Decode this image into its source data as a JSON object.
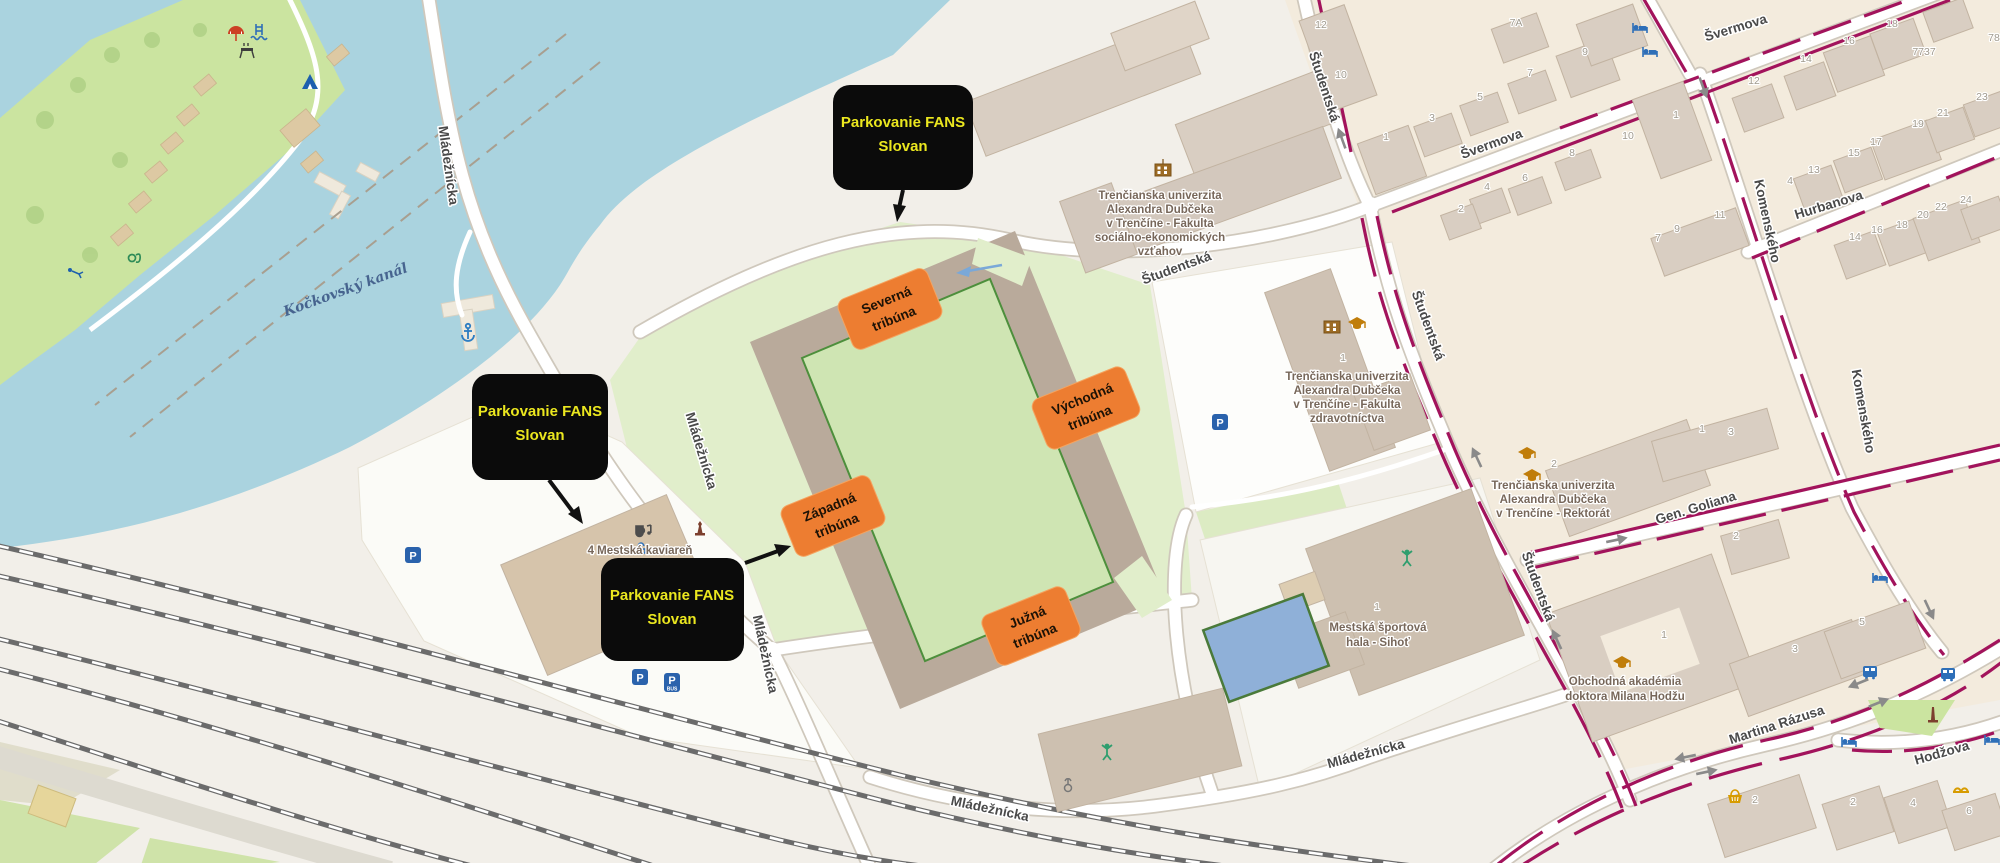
{
  "annotations": {
    "parking_box": {
      "line1": "Parkovanie FANS",
      "line2": "Slovan"
    },
    "stands": {
      "north": {
        "line1": "Severná",
        "line2": "tribúna"
      },
      "east": {
        "line1": "Východná",
        "line2": "tribúna"
      },
      "west": {
        "line1": "Západná",
        "line2": "tribúna"
      },
      "south": {
        "line1": "Južná",
        "line2": "tribúna"
      }
    },
    "colors": {
      "box_bg": "#0b0b0b",
      "box_text": "#ebe71f",
      "stand_bg": "#ed7d31",
      "arrow": "#111111"
    }
  },
  "streets": {
    "mladeznicka": "Mládežnícka",
    "studentska": "Študentská",
    "svermova": "Švermova",
    "hurbanova": "Hurbanova",
    "komenskeho": "Komenského",
    "gen_goliana": "Gen. Goliana",
    "martina_razusa": "Martina Rázusa",
    "hodzova": "Hodžova"
  },
  "water": {
    "label": "Kočkovský kanál",
    "color": "#aad3df"
  },
  "pois": {
    "uni_fse": {
      "l0": "Trenčianska univerzita",
      "l1": "Alexandra Dubčeka",
      "l2": "v Trenčíne - Fakulta",
      "l3": "sociálno-ekonomických",
      "l4": "vzťahov"
    },
    "uni_fz": {
      "l0": "Trenčianska univerzita",
      "l1": "Alexandra Dubčeka",
      "l2": "v Trenčíne - Fakulta",
      "l3": "zdravotníctva"
    },
    "uni_rektorat": {
      "l0": "Trenčianska univerzita",
      "l1": "Alexandra Dubčeka",
      "l2": "v Trenčíne - Rektorát"
    },
    "sport_hala": {
      "l0": "Mestská športová",
      "l1": "hala - Sihoť"
    },
    "akademia": {
      "l0": "Obchodná akadémia",
      "l1": "doktora Milana Hodžu"
    },
    "kaviaren": "4 Mestská kaviareň"
  },
  "icons": {
    "parking_letter": "P",
    "parking_bus_letter": "P",
    "parking_bus_sub": "BUS"
  },
  "house_numbers": [
    "12",
    "10",
    "1",
    "3",
    "5",
    "7",
    "7A",
    "9",
    "8",
    "6",
    "4",
    "12",
    "14",
    "16",
    "18",
    "10",
    "1",
    "11",
    "9",
    "7",
    "23",
    "21",
    "19",
    "17",
    "15",
    "13",
    "4",
    "14",
    "16",
    "18",
    "20",
    "22",
    "24",
    "7737",
    "78",
    "1",
    "1",
    "2",
    "1",
    "3",
    "2",
    "1",
    "3",
    "5",
    "2",
    "2",
    "4",
    "6",
    "2"
  ],
  "map_colors": {
    "cycle_lane": "#a2135c",
    "pitch": "#cfe5b3",
    "stands": "#b9aa9b",
    "grounds": "#e1eecb",
    "park": "#cbe4a0"
  }
}
